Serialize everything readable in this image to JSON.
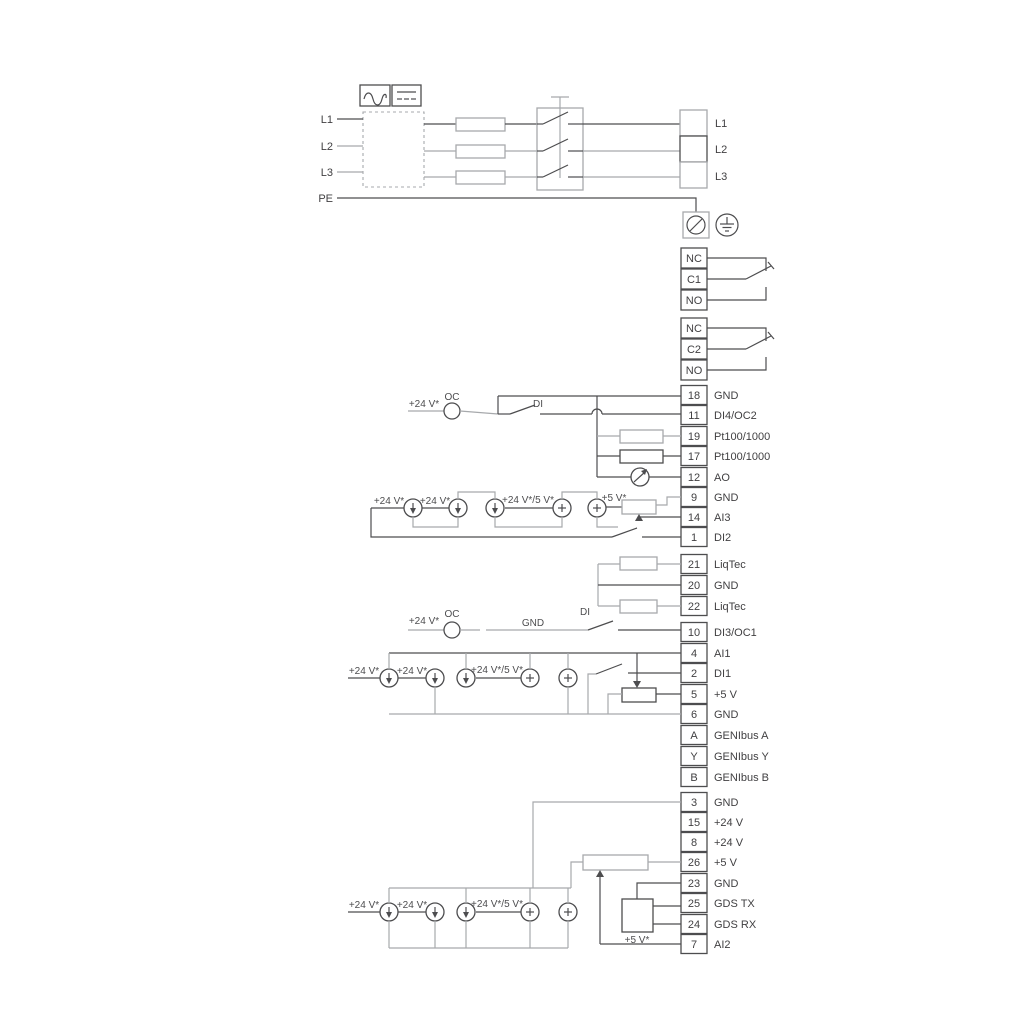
{
  "diagram": {
    "colors": {
      "line": "#4d4d4f",
      "line_gray": "#a7a9ac",
      "text": "#414042",
      "background": "#ffffff"
    },
    "mains_in": [
      "L1",
      "L2",
      "L3",
      "PE"
    ],
    "mains_out": [
      "L1",
      "L2",
      "L3"
    ],
    "relays": [
      [
        "NC",
        "C1",
        "NO"
      ],
      [
        "NC",
        "C2",
        "NO"
      ]
    ],
    "terminals": [
      {
        "no": "18",
        "label": "GND"
      },
      {
        "no": "11",
        "label": "DI4/OC2"
      },
      {
        "no": "19",
        "label": "Pt100/1000"
      },
      {
        "no": "17",
        "label": "Pt100/1000"
      },
      {
        "no": "12",
        "label": "AO"
      },
      {
        "no": "9",
        "label": "GND"
      },
      {
        "no": "14",
        "label": "AI3"
      },
      {
        "no": "1",
        "label": "DI2"
      },
      {
        "no": "21",
        "label": "LiqTec"
      },
      {
        "no": "20",
        "label": "GND"
      },
      {
        "no": "22",
        "label": "LiqTec"
      },
      {
        "no": "10",
        "label": "DI3/OC1"
      },
      {
        "no": "4",
        "label": "AI1"
      },
      {
        "no": "2",
        "label": "DI1"
      },
      {
        "no": "5",
        "label": "+5 V"
      },
      {
        "no": "6",
        "label": "GND"
      },
      {
        "no": "A",
        "label": "GENIbus A"
      },
      {
        "no": "Y",
        "label": "GENIbus Y"
      },
      {
        "no": "B",
        "label": "GENIbus B"
      },
      {
        "no": "3",
        "label": "GND"
      },
      {
        "no": "15",
        "label": "+24 V"
      },
      {
        "no": "8",
        "label": "+24 V"
      },
      {
        "no": "26",
        "label": "+5 V"
      },
      {
        "no": "23",
        "label": "GND"
      },
      {
        "no": "25",
        "label": "GDS TX"
      },
      {
        "no": "24",
        "label": "GDS RX"
      },
      {
        "no": "7",
        "label": "AI2"
      }
    ],
    "ann": {
      "v24": "+24 V*",
      "v24_5": "+24 V*/5 V*",
      "v5": "+5 V*",
      "oc": "OC",
      "di": "DI",
      "gnd": "GND"
    }
  }
}
